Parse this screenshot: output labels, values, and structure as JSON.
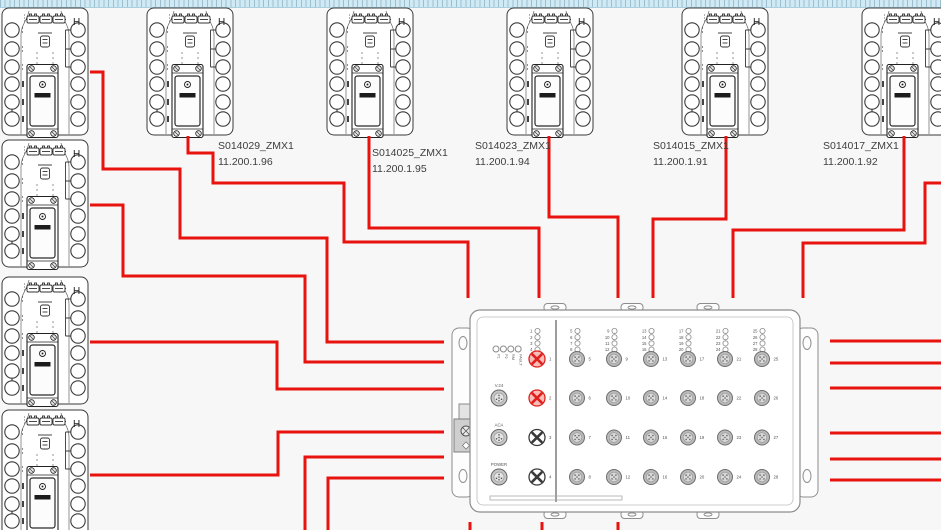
{
  "canvas": {
    "width": 941,
    "height": 530,
    "background": "#f7f7f7"
  },
  "module_symbol": {
    "h_label": "H"
  },
  "modules": [
    {
      "name": "module-left-1",
      "x": 1,
      "y": 7
    },
    {
      "name": "module-left-2",
      "x": 1,
      "y": 139
    },
    {
      "name": "module-left-3",
      "x": 1,
      "y": 276
    },
    {
      "name": "module-left-4",
      "x": 1,
      "y": 409
    },
    {
      "name": "module-top-1",
      "x": 146,
      "y": 7
    },
    {
      "name": "module-top-2",
      "x": 326,
      "y": 7
    },
    {
      "name": "module-top-3",
      "x": 506,
      "y": 7
    },
    {
      "name": "module-top-4",
      "x": 681,
      "y": 7
    },
    {
      "name": "module-top-5",
      "x": 861,
      "y": 7
    }
  ],
  "device_labels": [
    {
      "name": "S014029_ZMX1",
      "ip": "11.200.1.96",
      "x": 218,
      "y": 139
    },
    {
      "name": "S014025_ZMX1",
      "ip": "11.200.1.95",
      "x": 372,
      "y": 146
    },
    {
      "name": "S014023_ZMX1",
      "ip": "11.200.1.94",
      "x": 475,
      "y": 139
    },
    {
      "name": "S014015_ZMX1",
      "ip": "11.200.1.91",
      "x": 653,
      "y": 139
    },
    {
      "name": "S014017_ZMX1",
      "ip": "11.200.1.92",
      "x": 823,
      "y": 139
    }
  ],
  "switch": {
    "status_leds": [
      "P1",
      "P2",
      "RM",
      "FAULT"
    ],
    "side_ports": [
      "V.24",
      "ACA",
      "POWER"
    ],
    "led_groups": [
      [
        1,
        2,
        3,
        4
      ],
      [
        5,
        6,
        7,
        8
      ],
      [
        9,
        10,
        11,
        12
      ],
      [
        13,
        14,
        15,
        16
      ],
      [
        17,
        18,
        19,
        20
      ],
      [
        21,
        22,
        23,
        24
      ],
      [
        25,
        26,
        27,
        28
      ]
    ],
    "x_ports": [
      1,
      2,
      3,
      4
    ],
    "highlighted_ports": [
      1,
      2
    ],
    "round_ports": [
      [
        5,
        6,
        7,
        8
      ],
      [
        9,
        10,
        11,
        12
      ],
      [
        13,
        14,
        15,
        16
      ],
      [
        17,
        18,
        19,
        20
      ],
      [
        21,
        22,
        23,
        24
      ],
      [
        25,
        26,
        27,
        28
      ]
    ]
  },
  "wires": [
    [
      [
        90,
        72
      ],
      [
        103,
        72
      ],
      [
        103,
        169
      ],
      [
        180,
        169
      ],
      [
        180,
        238
      ],
      [
        327,
        238
      ],
      [
        327,
        342
      ],
      [
        444,
        342
      ]
    ],
    [
      [
        90,
        205
      ],
      [
        123,
        205
      ],
      [
        123,
        276
      ],
      [
        305,
        276
      ],
      [
        305,
        362
      ],
      [
        444,
        362
      ]
    ],
    [
      [
        90,
        342
      ],
      [
        277,
        342
      ],
      [
        277,
        389
      ],
      [
        444,
        389
      ]
    ],
    [
      [
        90,
        475
      ],
      [
        278,
        475
      ],
      [
        278,
        432
      ],
      [
        444,
        432
      ]
    ],
    [
      [
        305,
        530
      ],
      [
        305,
        457
      ],
      [
        444,
        457
      ]
    ],
    [
      [
        328,
        530
      ],
      [
        328,
        478
      ],
      [
        444,
        478
      ]
    ],
    [
      [
        188,
        136
      ],
      [
        188,
        153
      ],
      [
        213,
        153
      ],
      [
        213,
        183
      ],
      [
        344,
        183
      ],
      [
        344,
        242
      ],
      [
        468,
        242
      ],
      [
        468,
        298
      ]
    ],
    [
      [
        369,
        136
      ],
      [
        369,
        228
      ],
      [
        539,
        228
      ],
      [
        539,
        298
      ]
    ],
    [
      [
        549,
        136
      ],
      [
        549,
        217
      ],
      [
        618,
        217
      ],
      [
        618,
        298
      ]
    ],
    [
      [
        726,
        136
      ],
      [
        726,
        219
      ],
      [
        653,
        219
      ],
      [
        653,
        298
      ]
    ],
    [
      [
        904,
        136
      ],
      [
        904,
        230
      ],
      [
        733,
        230
      ],
      [
        733,
        298
      ]
    ],
    [
      [
        941,
        183
      ],
      [
        925,
        183
      ],
      [
        925,
        243
      ],
      [
        803,
        243
      ],
      [
        803,
        298
      ]
    ],
    [
      [
        830,
        341
      ],
      [
        941,
        341
      ]
    ],
    [
      [
        830,
        363
      ],
      [
        941,
        363
      ]
    ],
    [
      [
        830,
        388
      ],
      [
        941,
        388
      ]
    ],
    [
      [
        830,
        433
      ],
      [
        941,
        433
      ]
    ],
    [
      [
        830,
        459
      ],
      [
        941,
        459
      ]
    ],
    [
      [
        830,
        480
      ],
      [
        941,
        480
      ]
    ],
    [
      [
        470,
        522
      ],
      [
        470,
        530
      ]
    ],
    [
      [
        542,
        522
      ],
      [
        542,
        530
      ]
    ],
    [
      [
        618,
        522
      ],
      [
        618,
        530
      ]
    ]
  ],
  "colors": {
    "wire": "#e8120e",
    "module_stroke": "#333333",
    "switch_stroke": "#8d8d8d",
    "port_gray_fill": "#b9b9b9",
    "port_gray_inner": "#d9d9d9",
    "port_red": "#e0211d",
    "port_red_fill": "#f6bdb9",
    "label_text": "#3e3e3e"
  }
}
